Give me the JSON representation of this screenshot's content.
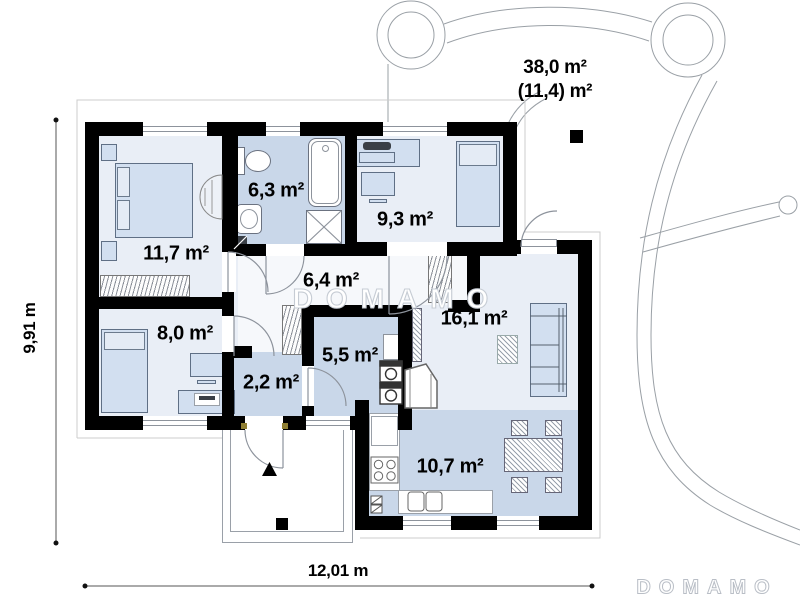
{
  "plan": {
    "rooms": [
      {
        "key": "bedroom-main",
        "area": "11,7 m²"
      },
      {
        "key": "bathroom",
        "area": "6,3 m²"
      },
      {
        "key": "bedroom-2",
        "area": "9,3 m²"
      },
      {
        "key": "hallway",
        "area": "6,4 m²"
      },
      {
        "key": "bedroom-3",
        "area": "8,0 m²"
      },
      {
        "key": "utility",
        "area": "5,5 m²"
      },
      {
        "key": "vestibule",
        "area": "2,2 m²"
      },
      {
        "key": "living-room",
        "area": "16,1 m²"
      },
      {
        "key": "kitchen-dining",
        "area": "10,7 m²"
      }
    ],
    "terrace": {
      "gross_area": "38,0 m²",
      "net_area": "(11,4) m²"
    },
    "dimensions": {
      "width": "12,01 m",
      "depth": "9,91 m"
    },
    "watermark": "DOMAMO",
    "watermark_corner": "DOMAMO"
  },
  "colors": {
    "wall": "#000000",
    "floor_light": "#e9eef6",
    "floor_hall": "#f6f8fb",
    "floor_blue": "#c9d7e9",
    "furniture": "#d2dff0"
  }
}
